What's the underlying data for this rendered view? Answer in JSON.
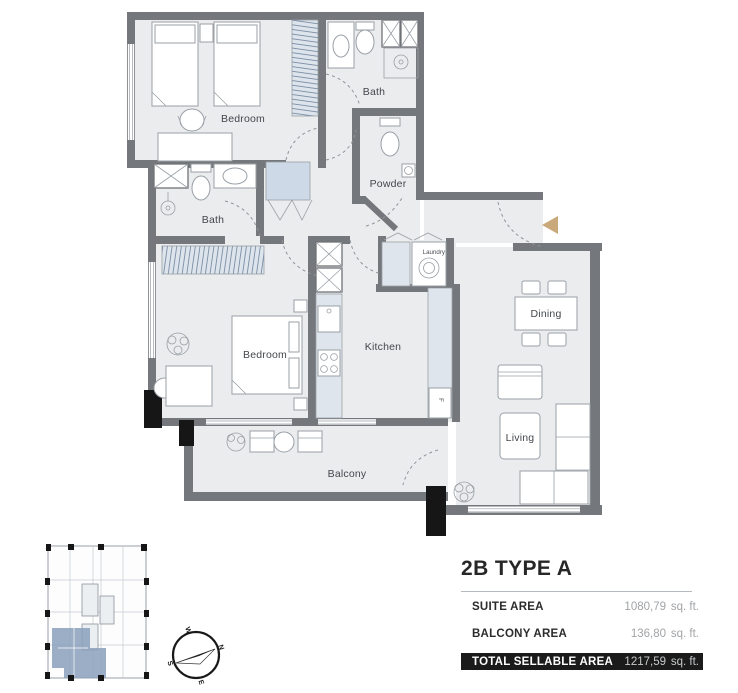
{
  "plan": {
    "rooms": {
      "bedroom1": "Bedroom",
      "bath1": "Bath",
      "powder": "Powder",
      "bath2": "Bath",
      "bedroom2": "Bedroom",
      "kitchen": "Kitchen",
      "laundry": "Laundry",
      "dining": "Dining",
      "living": "Living",
      "balcony": "Balcony"
    },
    "appliances": {
      "fridge": "F"
    },
    "colors": {
      "wall": "#74777b",
      "floor": "#eaecee",
      "counter": "#dfe5ec",
      "closet_hatch": "#dde4eb",
      "hall_closet": "#cdd9e7",
      "entry_arrow": "#c9a97a",
      "column": "#161616"
    }
  },
  "key_plan": {
    "compass": {
      "n": "N",
      "e": "E",
      "s": "S",
      "w": "W"
    },
    "highlight_color": "#8aa0bc"
  },
  "info_panel": {
    "title": "2B TYPE A",
    "rows": [
      {
        "label": "SUITE AREA",
        "value": "1080,79",
        "unit": "sq. ft."
      },
      {
        "label": "BALCONY AREA",
        "value": "136,80",
        "unit": "sq. ft."
      },
      {
        "label": "TOTAL SELLABLE AREA",
        "value": "1217,59",
        "unit": "sq. ft."
      }
    ]
  }
}
